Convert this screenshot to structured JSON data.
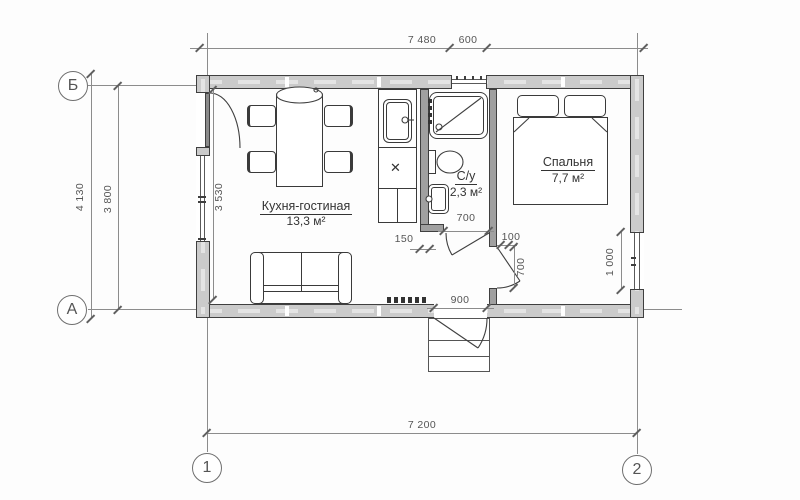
{
  "drawing": {
    "type": "floor-plan"
  },
  "colors": {
    "wall_fill": "#cbcbcb",
    "partition_fill": "#a0a0a0",
    "line": "#3f3f3f",
    "dim": "#8c8c8c",
    "bg": "#ffffff"
  },
  "axes": {
    "row_top": "Б",
    "row_bottom": "А",
    "col_left": "1",
    "col_right": "2"
  },
  "dimensions": {
    "top_main": "7 480",
    "top_window": "600",
    "left_outer": "4 130",
    "left_axes": "3 800",
    "left_inner": "3 530",
    "bottom_axes": "7 200",
    "counter_offset": "150",
    "bath_door_width": "700",
    "wall_stub": "100",
    "bedroom_door_width": "700",
    "entrance_width": "900",
    "right_window_height": "1 000"
  },
  "rooms": {
    "kitchen_living": {
      "name": "Кухня-гостиная",
      "area": "13,3 м²"
    },
    "bathroom": {
      "name": "С/у",
      "area": "2,3 м²"
    },
    "bedroom": {
      "name": "Спальня",
      "area": "7,7 м²"
    }
  },
  "icons": {
    "hob_burner": "✕"
  }
}
